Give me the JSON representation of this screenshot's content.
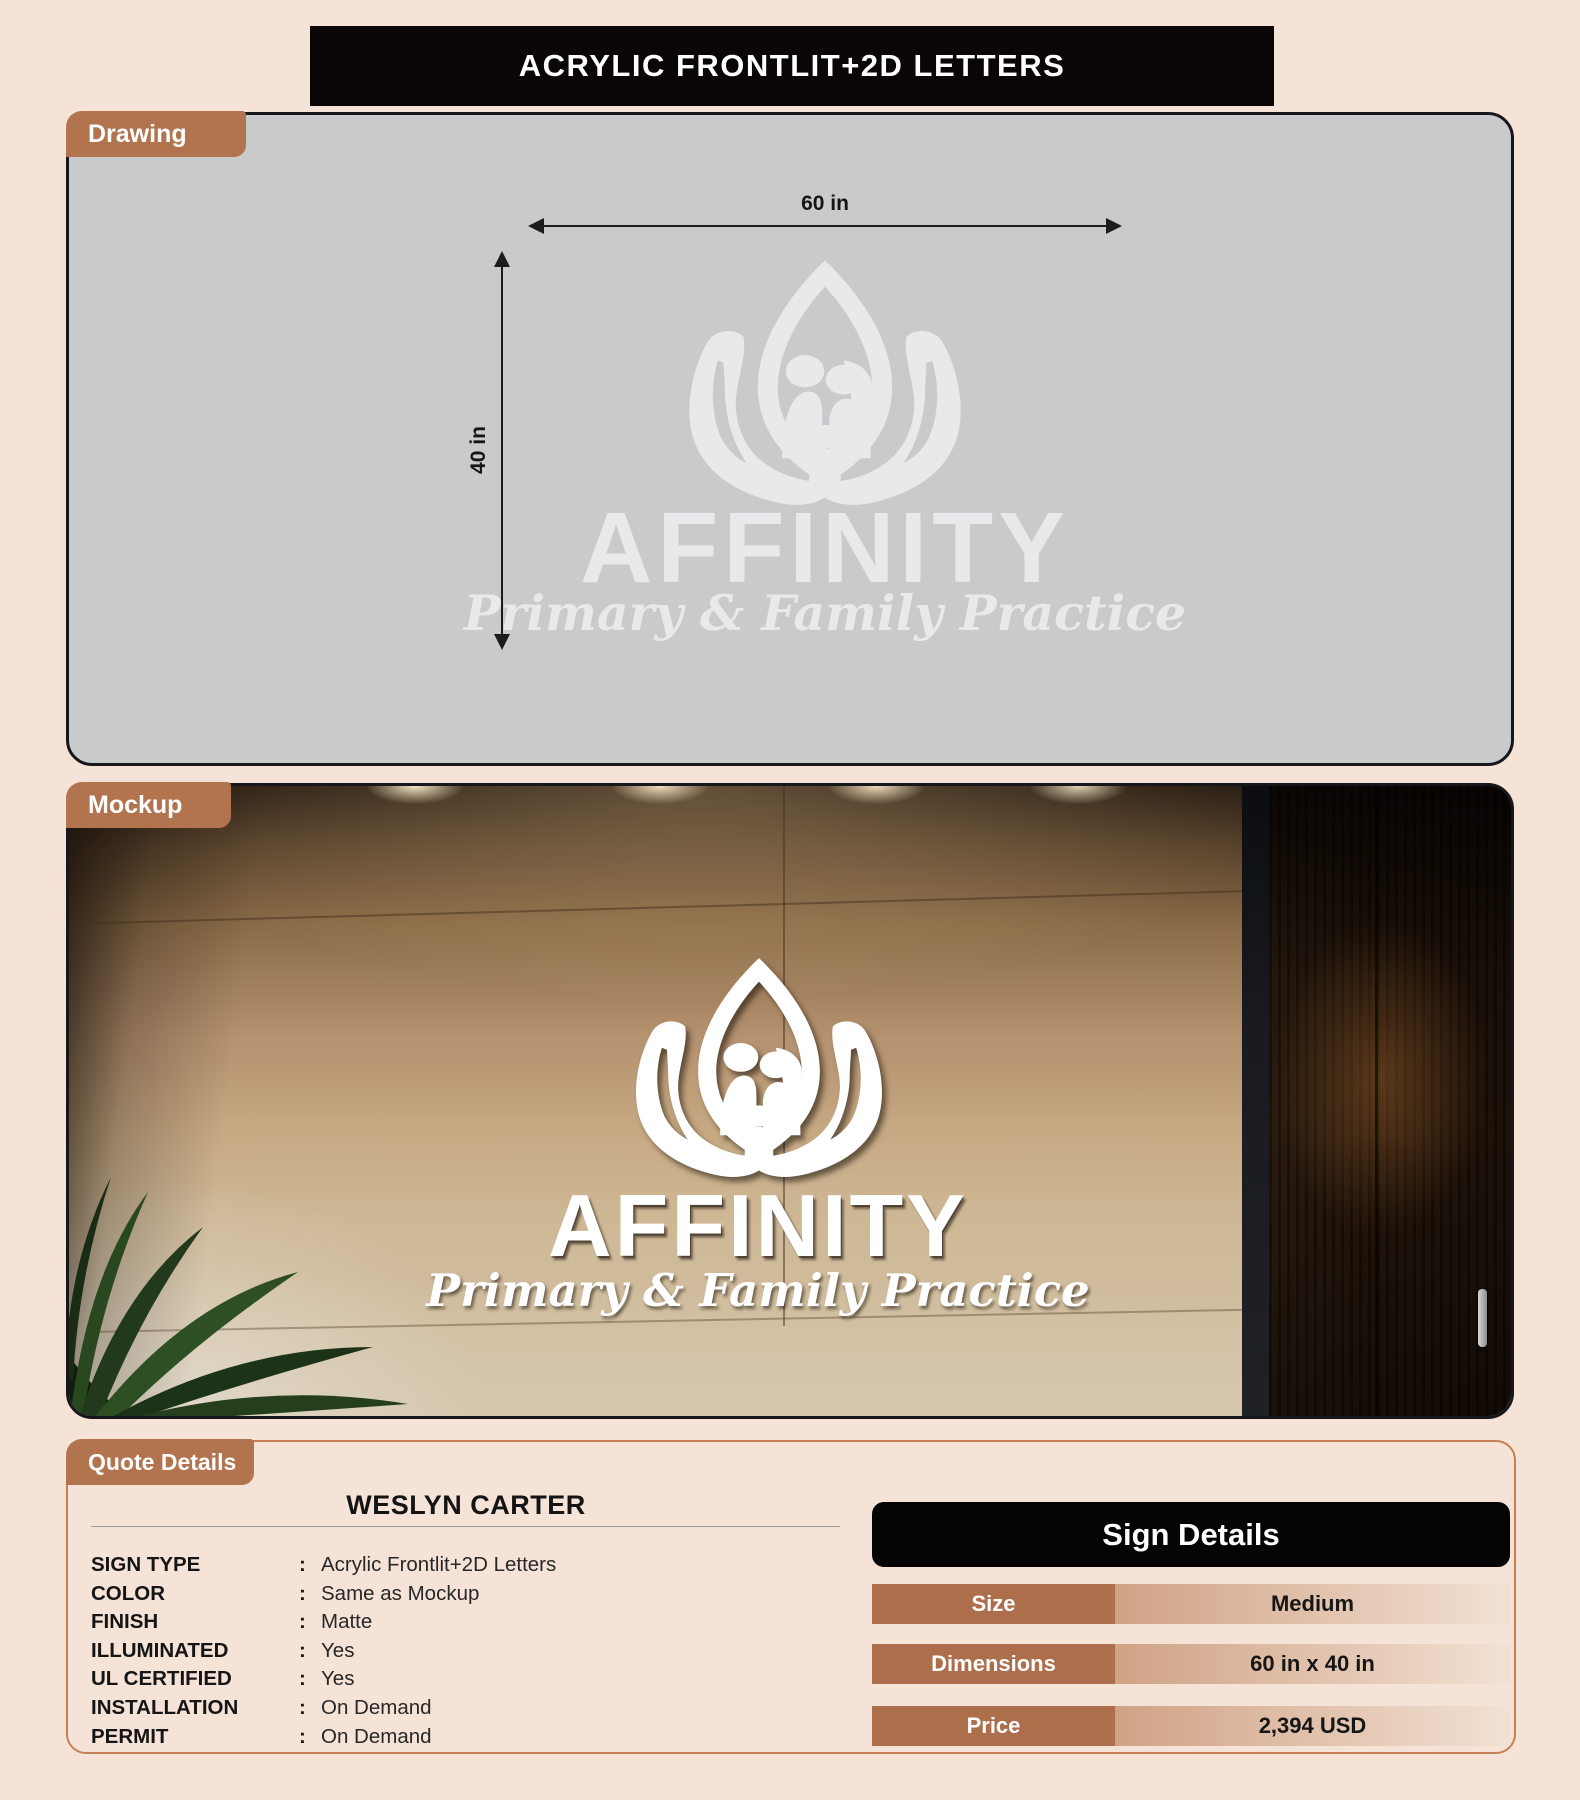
{
  "banner": {
    "title": "ACRYLIC FRONTLIT+2D LETTERS"
  },
  "drawing": {
    "tab_label": "Drawing",
    "width_dimension": "60 in",
    "height_dimension": "40 in",
    "logo": {
      "name": "AFFINITY",
      "tagline": "Primary & Family Practice"
    }
  },
  "mockup": {
    "tab_label": "Mockup",
    "logo": {
      "name": "AFFINITY",
      "tagline": "Primary & Family Practice"
    }
  },
  "quote": {
    "tab_label": "Quote Details",
    "customer_name": "WESLYN CARTER",
    "separator": ":",
    "specs": [
      {
        "label": "SIGN TYPE",
        "value": "Acrylic Frontlit+2D Letters"
      },
      {
        "label": "COLOR",
        "value": "Same as Mockup"
      },
      {
        "label": "FINISH",
        "value": "Matte"
      },
      {
        "label": "ILLUMINATED",
        "value": "Yes"
      },
      {
        "label": "UL CERTIFIED",
        "value": "Yes"
      },
      {
        "label": "INSTALLATION",
        "value": "On Demand"
      },
      {
        "label": "PERMIT",
        "value": "On Demand"
      }
    ],
    "sign_details": {
      "title": "Sign Details",
      "rows": [
        {
          "label": "Size",
          "value": "Medium"
        },
        {
          "label": "Dimensions",
          "value": "60 in x 40 in"
        },
        {
          "label": "Price",
          "value": "2,394 USD"
        }
      ]
    }
  },
  "colors": {
    "page_background": "#f6e3d7",
    "banner_black": "#0a0607",
    "tab_brown": "#b1744e",
    "drawing_panel_gray": "#c8cacc",
    "quote_border": "#c58155",
    "table_label_brown": "#ad6e4b",
    "table_value_gradient_start": "#d0a285",
    "table_value_gradient_end": "#f2e1d3"
  }
}
